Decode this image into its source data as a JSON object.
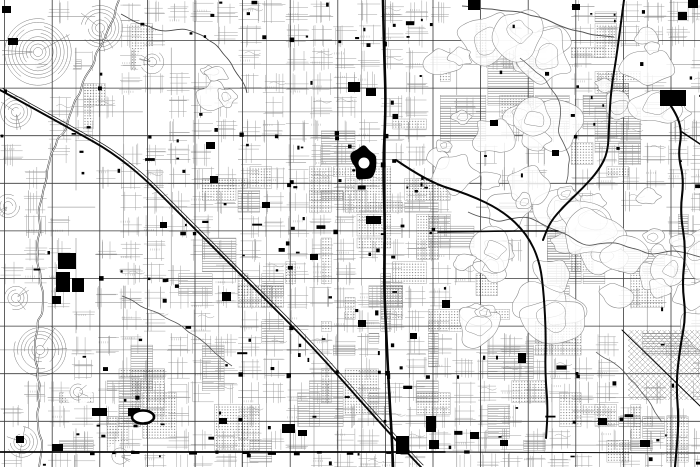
{
  "map": {
    "width": 700,
    "height": 467,
    "seed": 1337,
    "base_density": 0.82,
    "colors": {
      "background": "#ffffff",
      "minor_street": "#9b9b9b",
      "comb": "#a6a6a6",
      "half_street": "#7c7c7c",
      "arterial": "#3a3a3a",
      "major_road": "#060606",
      "railroad": "#161616",
      "river": "#2e2e2e",
      "river_core": "#ffffff",
      "canal": "#444444",
      "winding": "#555555",
      "contour": "#8a8a8a",
      "block_dot": "#787878",
      "block_edge": "#8e8e8e",
      "building": "#000000"
    },
    "grid": {
      "x0": 4.6,
      "y0": 40.5,
      "step": 47.6,
      "cell": 23.8,
      "half_v0": 28.4,
      "half_h0": 16.7
    },
    "sparse": [
      [
        0,
        140,
        62,
        327,
        0.35
      ],
      [
        62,
        150,
        58,
        160,
        0.5
      ],
      [
        0,
        0,
        190,
        140,
        0.5
      ],
      [
        620,
        328,
        80,
        80,
        0.18
      ],
      [
        545,
        180,
        150,
        165,
        0.3
      ]
    ],
    "terrain": [
      [
        432,
        42,
        130,
        170,
        14
      ],
      [
        455,
        150,
        150,
        185,
        16
      ],
      [
        548,
        185,
        140,
        155,
        12
      ],
      [
        598,
        36,
        86,
        92,
        7
      ],
      [
        618,
        228,
        82,
        105,
        7
      ],
      [
        198,
        52,
        44,
        48,
        4
      ],
      [
        452,
        8,
        110,
        60,
        6
      ]
    ],
    "curvy": [
      [
        38,
        52,
        36
      ],
      [
        100,
        28,
        24
      ],
      [
        16,
        112,
        18
      ],
      [
        152,
        62,
        13
      ],
      [
        40,
        350,
        27
      ],
      [
        16,
        298,
        15
      ],
      [
        22,
        442,
        16
      ],
      [
        8,
        206,
        12
      ],
      [
        120,
        456,
        11
      ],
      [
        78,
        392,
        11
      ]
    ],
    "gray_blocks": [
      [
        288,
        95,
        182,
        370,
        42
      ],
      [
        180,
        150,
        108,
        315,
        15
      ],
      [
        470,
        190,
        230,
        272,
        24
      ],
      [
        478,
        0,
        165,
        130,
        10
      ],
      [
        560,
        88,
        90,
        95,
        8
      ],
      [
        58,
        338,
        122,
        127,
        8
      ],
      [
        598,
        332,
        102,
        133,
        8
      ],
      [
        0,
        0,
        180,
        140,
        5
      ],
      [
        432,
        40,
        130,
        160,
        4
      ],
      [
        60,
        390,
        120,
        70,
        5
      ]
    ],
    "majors": [
      {
        "name": "freeway-i17",
        "width": 2.6,
        "points": [
          [
            383,
            0
          ],
          [
            384,
            50
          ],
          [
            386,
            105
          ],
          [
            383,
            165
          ],
          [
            385,
            225
          ],
          [
            384,
            285
          ],
          [
            386,
            330
          ],
          [
            389,
            390
          ],
          [
            392,
            440
          ],
          [
            393,
            467
          ]
        ]
      },
      {
        "name": "grand-avenue",
        "width": 1.9,
        "points": [
          [
            0,
            90
          ],
          [
            62,
            124
          ],
          [
            126,
            160
          ],
          [
            192,
            226
          ],
          [
            252,
            286
          ],
          [
            312,
            346
          ],
          [
            372,
            414
          ],
          [
            414,
            460
          ],
          [
            421,
            467
          ]
        ]
      },
      {
        "name": "cave-creek-road",
        "width": 2.0,
        "points": [
          [
            396,
            160
          ],
          [
            428,
            182
          ],
          [
            468,
            194
          ],
          [
            503,
            211
          ],
          [
            527,
            234
          ],
          [
            540,
            262
          ],
          [
            544,
            296
          ],
          [
            546,
            336
          ],
          [
            545,
            372
          ],
          [
            548,
            408
          ],
          [
            546,
            438
          ]
        ]
      },
      {
        "name": "north-vertical-road",
        "width": 2.0,
        "points": [
          [
            624,
            0
          ],
          [
            620,
            30
          ],
          [
            616,
            60
          ],
          [
            611,
            90
          ],
          [
            609,
            125
          ],
          [
            608,
            152
          ],
          [
            599,
            170
          ],
          [
            583,
            188
          ],
          [
            565,
            205
          ],
          [
            550,
            222
          ],
          [
            543,
            240
          ]
        ]
      },
      {
        "name": "east-highway",
        "width": 2.1,
        "points": [
          [
            664,
            96
          ],
          [
            676,
            112
          ],
          [
            682,
            132
          ],
          [
            678,
            155
          ],
          [
            684,
            180
          ],
          [
            680,
            212
          ],
          [
            686,
            248
          ],
          [
            682,
            284
          ],
          [
            686,
            316
          ],
          [
            680,
            348
          ],
          [
            676,
            384
          ],
          [
            679,
            422
          ],
          [
            675,
            467
          ]
        ]
      },
      {
        "name": "east-spur",
        "width": 1.5,
        "points": [
          [
            682,
            132
          ],
          [
            700,
            144
          ]
        ]
      },
      {
        "name": "mid-horizontal-road",
        "width": 1.6,
        "points": [
          [
            438,
            232
          ],
          [
            500,
            231
          ],
          [
            558,
            231
          ]
        ]
      },
      {
        "name": "south-arterial",
        "width": 1.8,
        "points": [
          [
            0,
            452
          ],
          [
            445,
            452
          ]
        ]
      },
      {
        "name": "south-arterial-east",
        "width": 1.0,
        "points": [
          [
            445,
            452
          ],
          [
            700,
            453
          ]
        ]
      },
      {
        "name": "patch-boundary-road",
        "width": 1.0,
        "points": [
          [
            622,
            330
          ],
          [
            700,
            406
          ]
        ]
      }
    ],
    "railroad_offset": [
      2.4,
      -1.8
    ],
    "rivers": [
      {
        "name": "river",
        "points": [
          [
            119,
            0
          ],
          [
            112,
            22
          ],
          [
            101,
            46
          ],
          [
            90,
            70
          ],
          [
            80,
            94
          ],
          [
            68,
            120
          ],
          [
            56,
            146
          ],
          [
            47,
            170
          ],
          [
            43,
            192
          ],
          [
            39,
            218
          ],
          [
            37,
            246
          ],
          [
            41,
            274
          ],
          [
            43,
            300
          ],
          [
            38,
            328
          ],
          [
            35,
            356
          ],
          [
            40,
            384
          ],
          [
            37,
            412
          ],
          [
            42,
            440
          ],
          [
            39,
            467
          ]
        ]
      }
    ],
    "canals": [
      {
        "name": "canal",
        "points": [
          [
            121,
            14
          ],
          [
            140,
            24
          ],
          [
            162,
            31
          ],
          [
            184,
            29
          ],
          [
            204,
            36
          ],
          [
            219,
            48
          ],
          [
            231,
            63
          ],
          [
            241,
            79
          ],
          [
            247,
            93
          ]
        ]
      }
    ],
    "winding_roads": [
      {
        "w": 0.9,
        "points": [
          [
            468,
            212
          ],
          [
            498,
            222
          ],
          [
            528,
            217
          ],
          [
            558,
            231
          ],
          [
            588,
            246
          ],
          [
            618,
            243
          ],
          [
            648,
            254
          ],
          [
            678,
            251
          ],
          [
            700,
            257
          ]
        ]
      },
      {
        "w": 0.8,
        "points": [
          [
            520,
            58
          ],
          [
            545,
            78
          ],
          [
            560,
            103
          ],
          [
            558,
            133
          ],
          [
            570,
            158
          ],
          [
            566,
            184
          ]
        ]
      },
      {
        "w": 1.0,
        "points": [
          [
            462,
            6
          ],
          [
            492,
            9
          ],
          [
            522,
            12
          ],
          [
            548,
            20
          ],
          [
            572,
            30
          ],
          [
            592,
            35
          ],
          [
            614,
            37
          ]
        ]
      },
      {
        "w": 0.8,
        "points": [
          [
            596,
            352
          ],
          [
            618,
            366
          ],
          [
            636,
            384
          ],
          [
            650,
            402
          ],
          [
            662,
            422
          ]
        ]
      },
      {
        "w": 0.8,
        "points": [
          [
            122,
            296
          ],
          [
            150,
            310
          ],
          [
            175,
            322
          ],
          [
            196,
            336
          ],
          [
            214,
            352
          ],
          [
            232,
            366
          ]
        ]
      }
    ],
    "diagonal_patch": {
      "x": 628,
      "y": 330,
      "w": 72,
      "h": 70,
      "spacing": 5.5
    },
    "landmarks": [
      [
        58,
        253,
        18,
        16
      ],
      [
        56,
        272,
        14,
        20
      ],
      [
        72,
        278,
        12,
        14
      ],
      [
        52,
        296,
        9,
        8
      ],
      [
        366,
        216,
        15,
        8
      ],
      [
        210,
        176,
        8,
        7
      ],
      [
        222,
        292,
        9,
        9
      ],
      [
        282,
        424,
        13,
        9
      ],
      [
        298,
        430,
        9,
        6
      ],
      [
        426,
        416,
        10,
        16
      ],
      [
        396,
        436,
        13,
        18
      ],
      [
        429,
        440,
        10,
        9
      ],
      [
        518,
        353,
        8,
        10
      ],
      [
        660,
        90,
        26,
        16
      ],
      [
        678,
        12,
        9,
        8
      ],
      [
        572,
        4,
        8,
        6
      ],
      [
        468,
        0,
        12,
        10
      ],
      [
        688,
        0,
        10,
        8
      ],
      [
        92,
        408,
        15,
        8
      ],
      [
        128,
        408,
        12,
        8
      ],
      [
        52,
        444,
        11,
        7
      ],
      [
        16,
        436,
        8,
        7
      ],
      [
        348,
        82,
        12,
        10
      ],
      [
        366,
        88,
        10,
        8
      ],
      [
        206,
        142,
        9,
        7
      ],
      [
        262,
        202,
        8,
        6
      ],
      [
        442,
        300,
        8,
        8
      ],
      [
        470,
        432,
        9,
        7
      ],
      [
        500,
        440,
        8,
        6
      ],
      [
        598,
        418,
        9,
        7
      ],
      [
        640,
        440,
        10,
        7
      ],
      [
        219,
        418,
        8,
        6
      ],
      [
        160,
        222,
        7,
        6
      ],
      [
        310,
        254,
        8,
        6
      ],
      [
        358,
        320,
        8,
        7
      ],
      [
        410,
        333,
        7,
        6
      ],
      [
        490,
        120,
        8,
        6
      ],
      [
        552,
        150,
        7,
        6
      ],
      [
        8,
        38,
        10,
        7
      ],
      [
        2,
        6,
        9,
        7
      ]
    ],
    "lake": {
      "cx": 364,
      "cy": 163,
      "rx": 13,
      "ry": 15,
      "hole": 5.5
    },
    "oval_track": {
      "cx": 143,
      "cy": 417,
      "rx": 11,
      "ry": 6.5,
      "stroke": 2.6
    },
    "random_buildings": {
      "count": 150,
      "attempts": 480,
      "min": 1.6,
      "max": 4.2
    },
    "intersection_blotches": {
      "count": 54,
      "min": 2.2,
      "max": 4.6
    },
    "south_strip_blotches": {
      "count": 12
    },
    "freeway_blotches": {
      "count": 9
    }
  }
}
